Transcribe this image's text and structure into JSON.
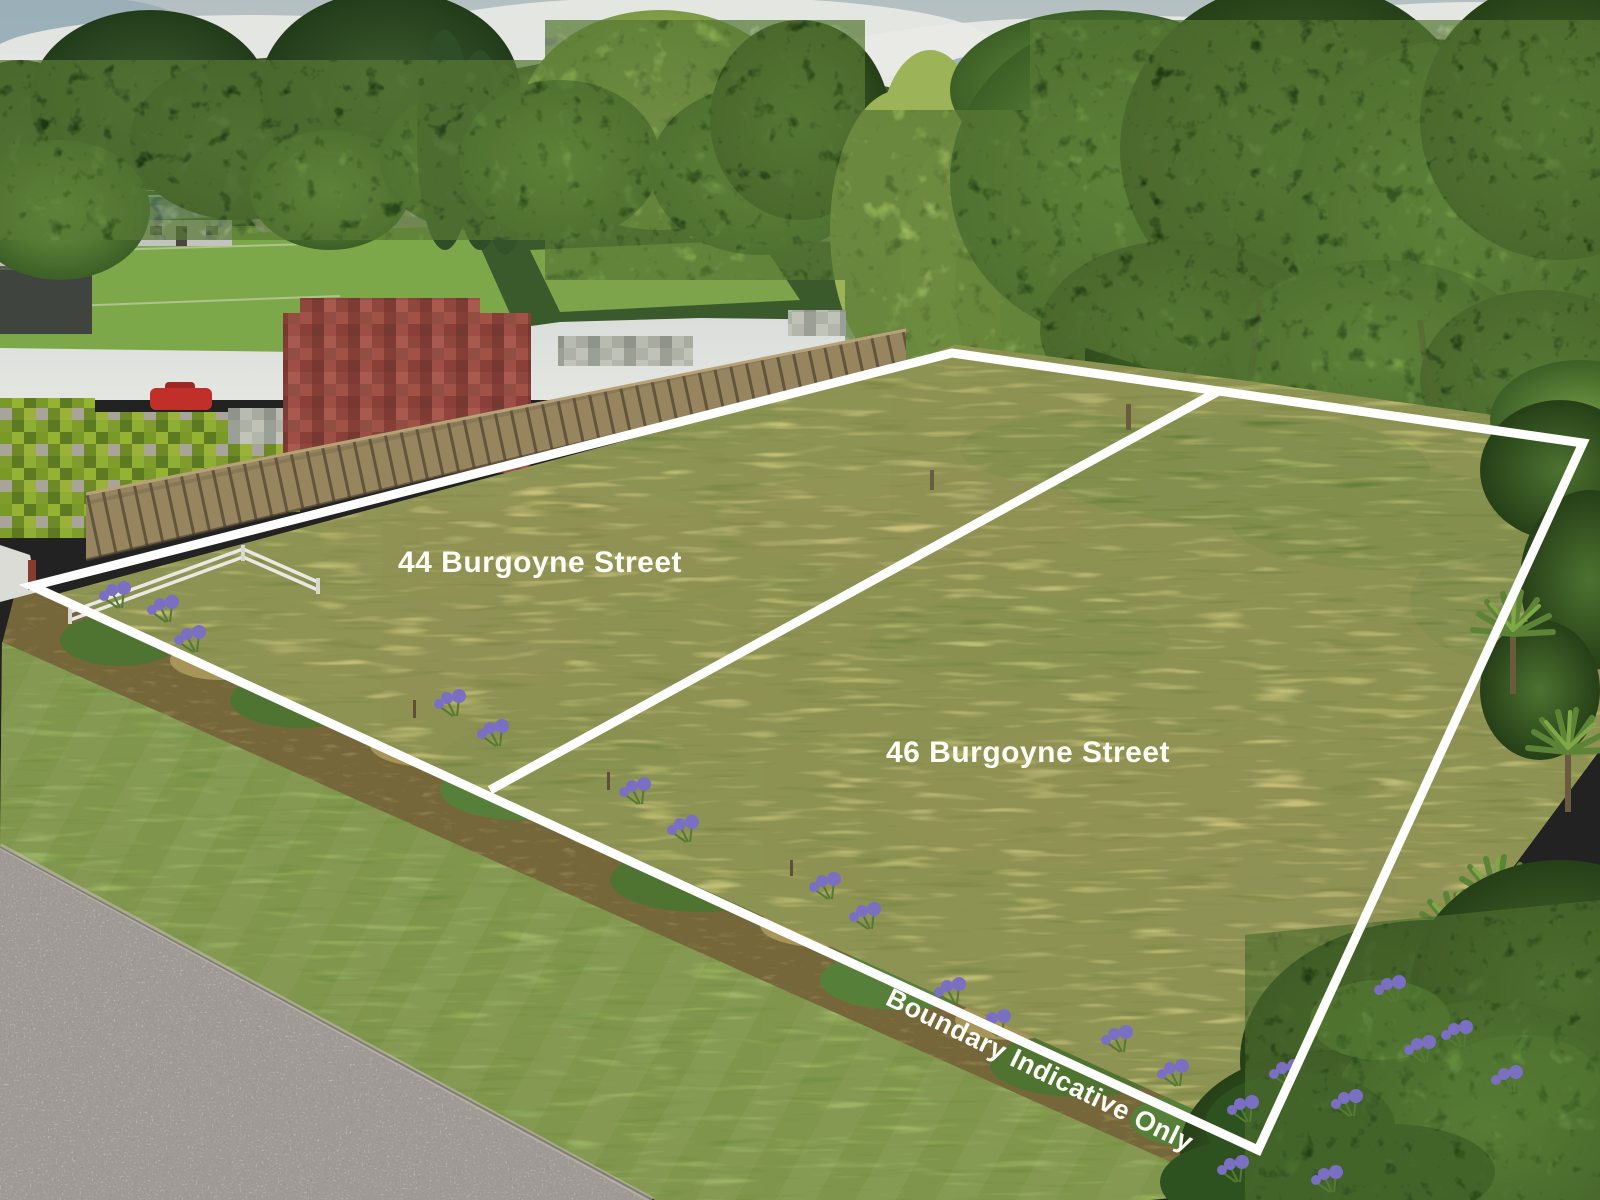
{
  "photo": {
    "type": "aerial drone photograph of two vacant grass sections for sale, white boundary overlay",
    "labels": {
      "lot44": "44 Burgoyne Street",
      "lot46": "46 Burgoyne Street",
      "disclaimer": "Boundary Indicative Only"
    },
    "colors": {
      "boundary_line": "#ffffff",
      "label_text": "#fdfdf8",
      "field_grass": "#a3aa5c",
      "dry_grass": "#b5ab69",
      "mown_verge": "#7fa44c",
      "road_asphalt": "#a29e9a",
      "fence_wood": "#97855f",
      "barn_red": "#9c4b41",
      "tree_dark": "#2e4d22",
      "tree_mid": "#53793a",
      "tree_light": "#9ab35e",
      "agapanthus_purple": "#7b6fc4",
      "sky": "#c9cecb",
      "cloud": "#e9eae6"
    }
  }
}
